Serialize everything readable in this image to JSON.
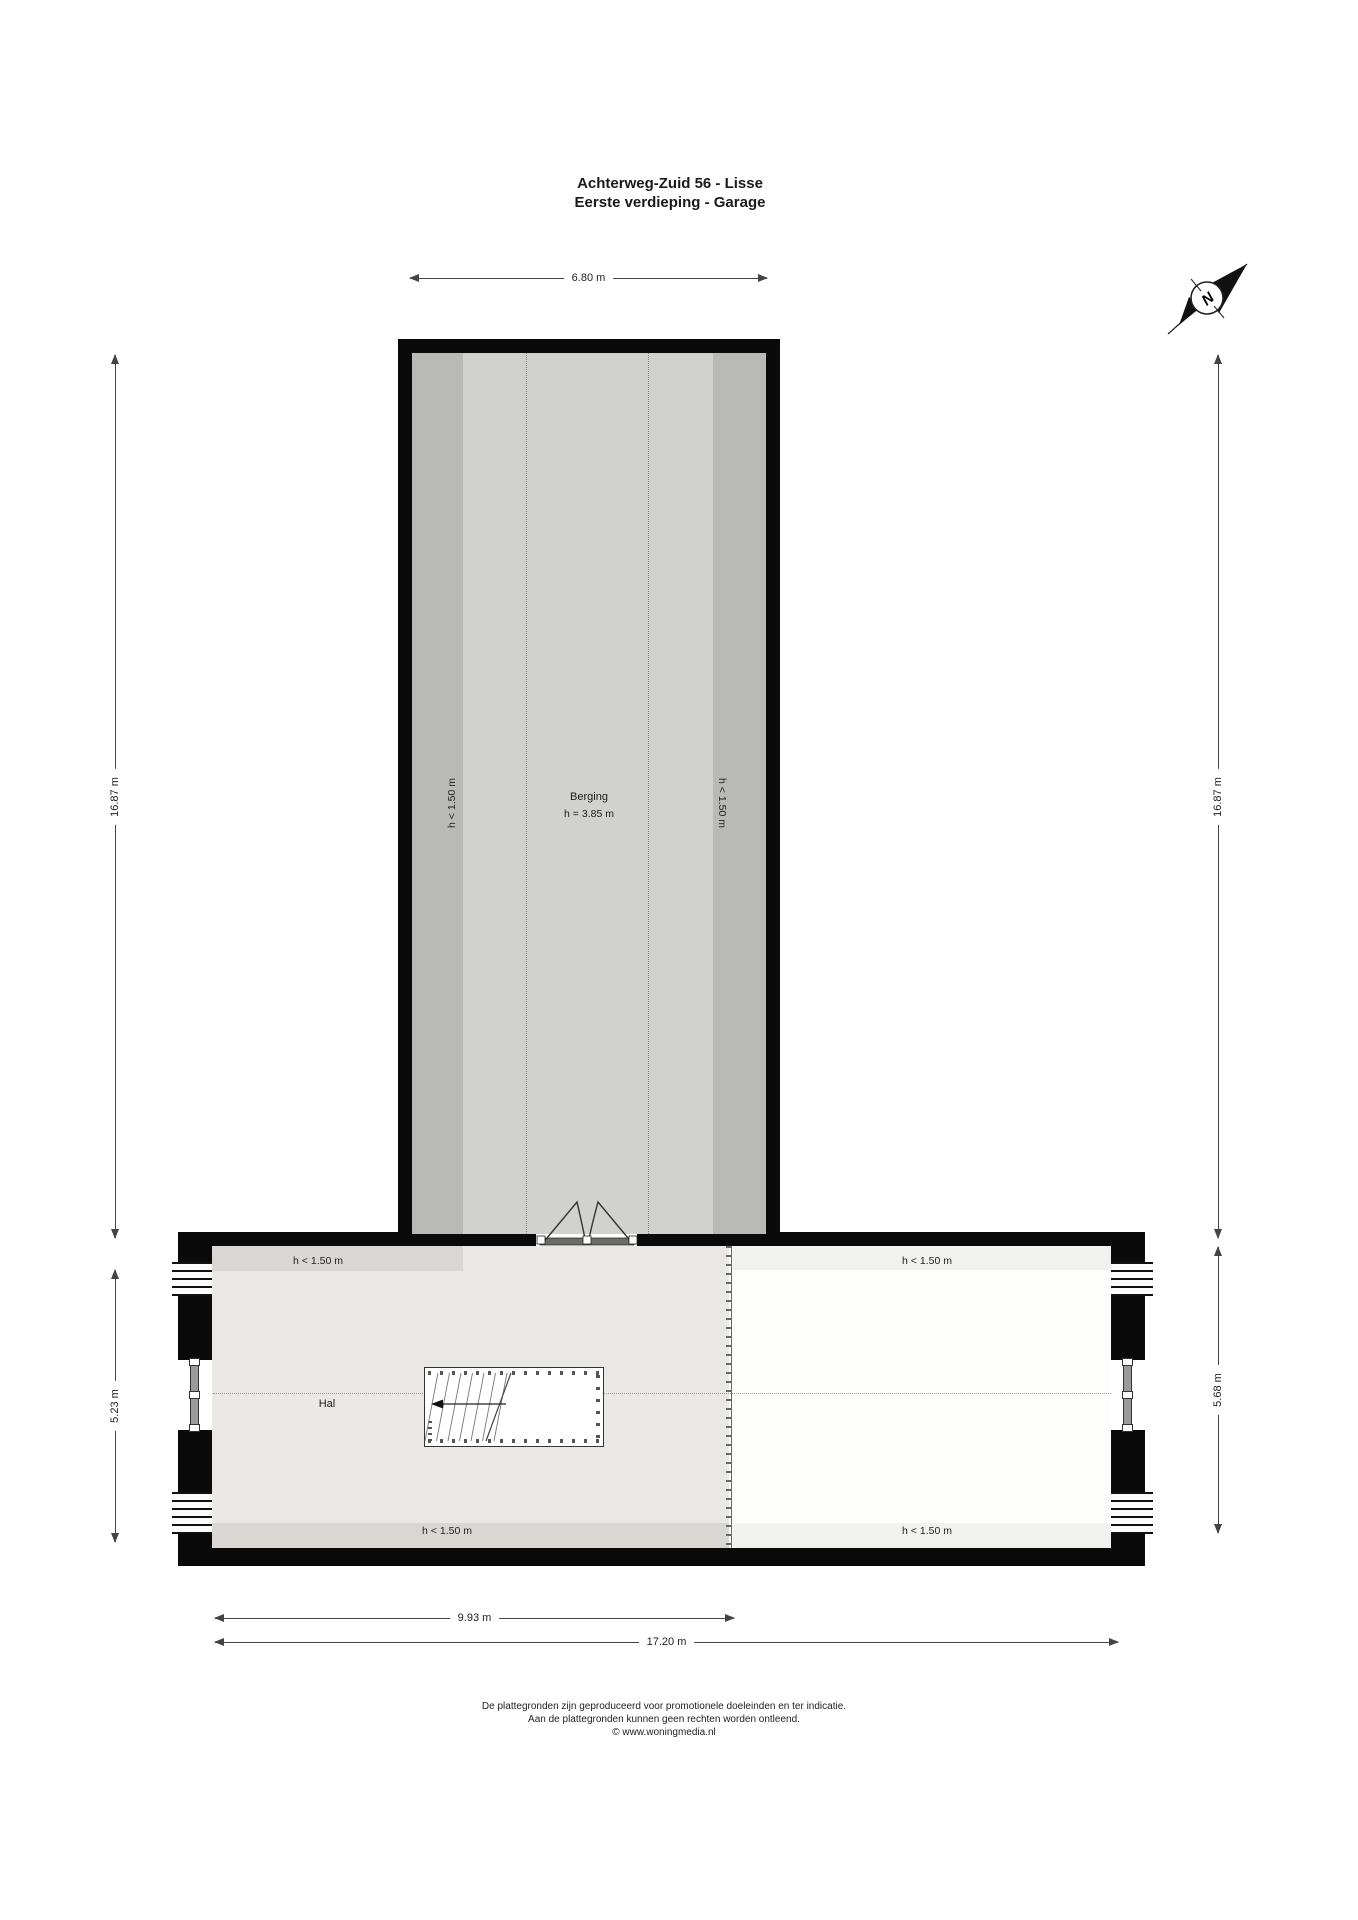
{
  "title": {
    "line1": "Achterweg-Zuid 56 - Lisse",
    "line2": "Eerste verdieping - Garage"
  },
  "compass": {
    "label": "N"
  },
  "rooms": {
    "berging": {
      "name": "Berging",
      "height_note": "h = 3.85 m",
      "low_left": "h < 1.50 m",
      "low_right": "h < 1.50 m"
    },
    "hal": {
      "name": "Hal",
      "low_top_left": "h < 1.50 m",
      "low_top_right": "h < 1.50 m",
      "low_bottom_left": "h < 1.50 m",
      "low_bottom_right": "h < 1.50 m"
    }
  },
  "dimensions": {
    "berging_width": "6.80 m",
    "total_height_left": "16.87 m",
    "total_height_right": "16.87 m",
    "hal_height_left": "5.23 m",
    "hal_height_right": "5.68 m",
    "hal_width_inner": "9.93 m",
    "total_width": "17.20 m"
  },
  "footer": {
    "line1": "De plattegronden zijn geproduceerd voor promotionele doeleinden en ter indicatie.",
    "line2": "Aan de plattegronden kunnen geen rechten worden ontleend.",
    "line3": "© www.woningmedia.nl"
  },
  "colors": {
    "wall": "#0a0a0a",
    "berging_floor": "#d1d1cf",
    "berging_low_strip": "#b9b9b7",
    "hal_floor": "#e9e8e4",
    "low_band_dark": "#d8d7d3",
    "low_band_light": "#f1f1ef",
    "attic_floor": "#fdfdfc"
  }
}
